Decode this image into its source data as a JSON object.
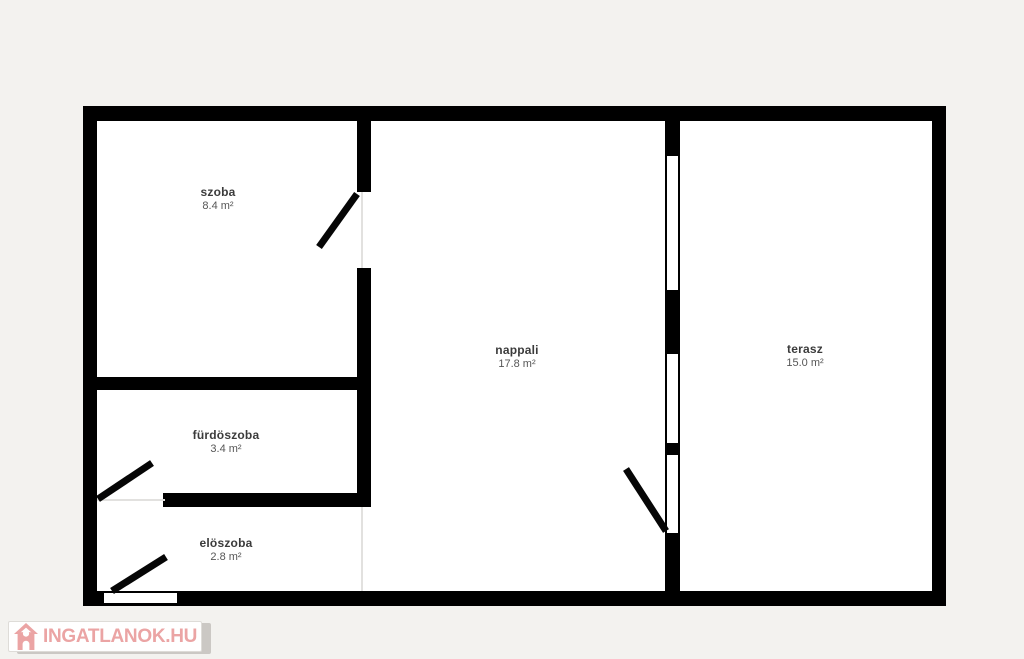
{
  "rooms": {
    "szoba": {
      "name": "szoba",
      "area": "8.4 m²"
    },
    "furdoszoba": {
      "name": "fürdöszoba",
      "area": "3.4 m²"
    },
    "eloszoba": {
      "name": "elöszoba",
      "area": "2.8 m²"
    },
    "nappali": {
      "name": "nappali",
      "area": "17.8 m²"
    },
    "terasz": {
      "name": "terasz",
      "area": "15.0 m²"
    }
  },
  "watermark": {
    "text": "INGATLANOK.HU",
    "icon": "house-icon",
    "color": "#eba4a4"
  },
  "colors": {
    "wall": "#000000",
    "floor": "#ffffff",
    "background": "#f3f2ef"
  }
}
